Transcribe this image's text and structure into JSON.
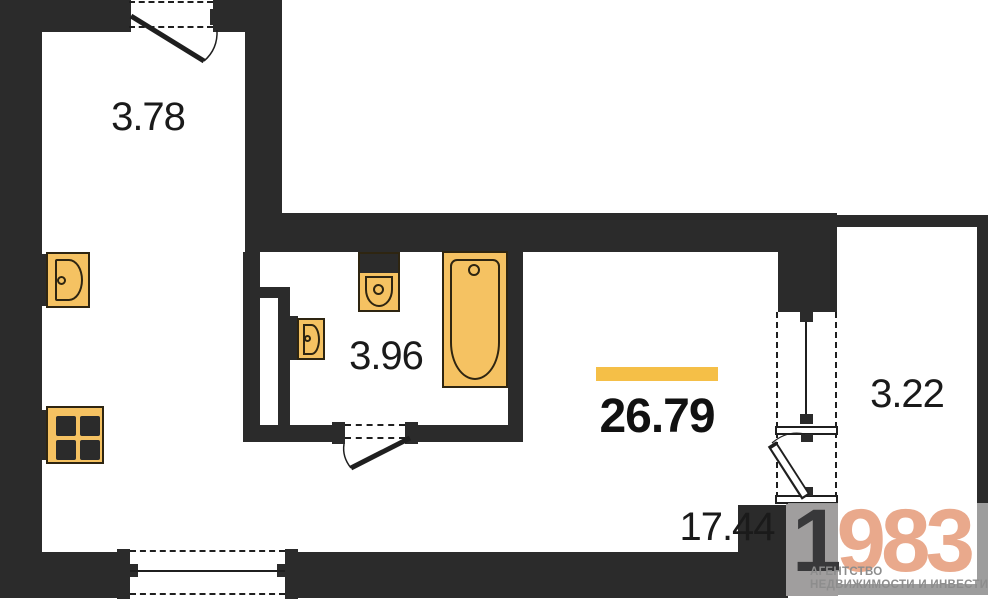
{
  "plan": {
    "rooms": [
      {
        "id": "hallway",
        "area_label": "3.78"
      },
      {
        "id": "bathroom",
        "area_label": "3.96"
      },
      {
        "id": "living_kitchen",
        "area_label": "17.44"
      },
      {
        "id": "balcony",
        "area_label": "3.22"
      }
    ],
    "total_area_label": "26.79",
    "fixtures": [
      "kitchen-sink",
      "stove",
      "toilet",
      "wash-basin",
      "bathtub"
    ],
    "colors": {
      "wall": "#2b2b2b",
      "line": "#1f1f1f",
      "text": "#1a1a1a",
      "fixture_fill": "#f5c262",
      "fixture_outline": "#2e2511",
      "accent_bar": "#f5bf47",
      "wm_salmon": "#e9a98c",
      "wm_gray": "#8d8d8d",
      "wm_box": "#a09e9e"
    }
  },
  "watermark": {
    "digit_prefix": "1",
    "digits": "983",
    "line1": "АГЕНТСТВО",
    "line2": "НЕДВИЖИМОСТИ И ИНВЕСТИЦИЙ"
  }
}
